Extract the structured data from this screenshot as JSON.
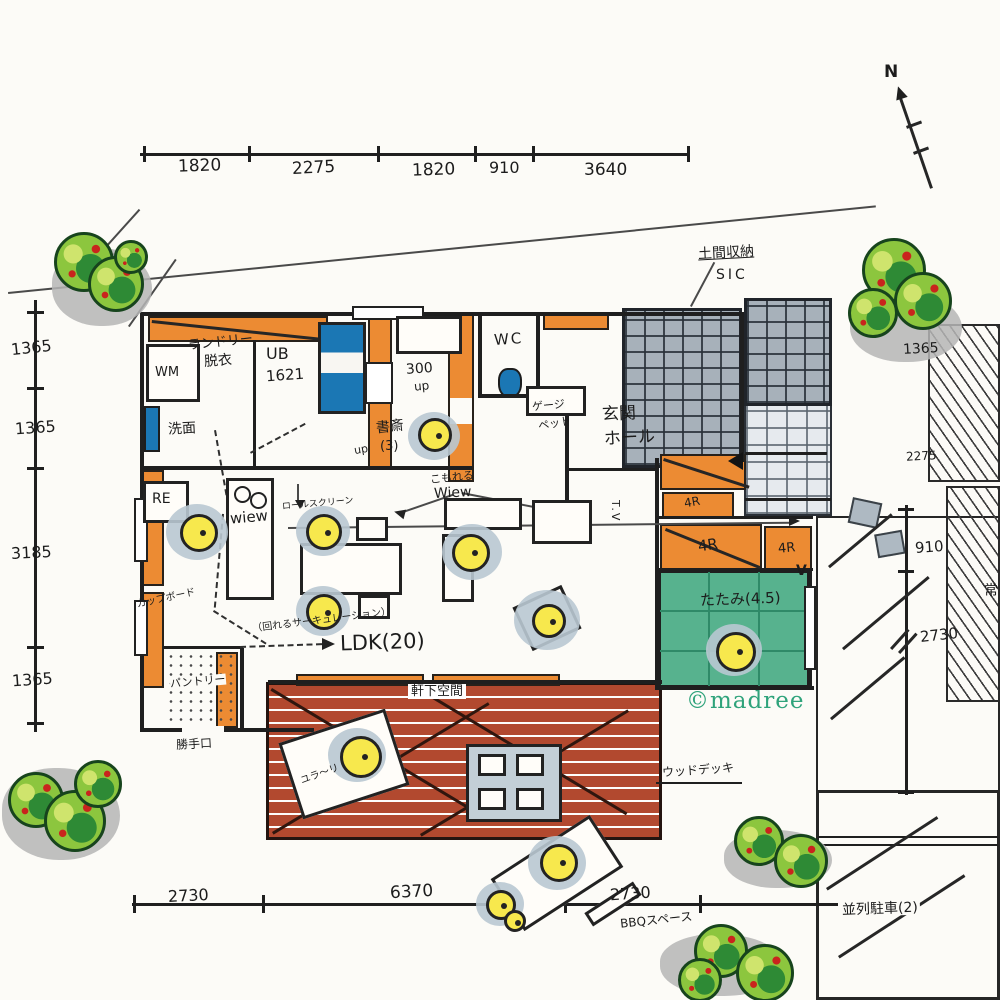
{
  "watermark": {
    "text": "©madree",
    "color": "#2fa37b"
  },
  "compass": {
    "label": "N"
  },
  "dims": {
    "top": [
      "1820",
      "2275",
      "1820",
      "910",
      "3640"
    ],
    "left": [
      "1365",
      "1365",
      "3185",
      "1365"
    ],
    "bottom": [
      "2730",
      "6370",
      "2730"
    ],
    "right_outer": [
      "1365",
      "2275"
    ],
    "right_inner": [
      "910",
      "2730"
    ]
  },
  "rooms": {
    "laundry1": "ランドリー",
    "laundry2": "脱衣",
    "wm": "WM",
    "ub": "UB",
    "ub_size": "1621",
    "washroom": "洗面",
    "fridge": "RE",
    "study": "書斎",
    "study_size": "(3)",
    "stair_rise": "300",
    "stair_up": "up",
    "hall_up": "up",
    "wc": "WC",
    "cage": "ゲージ",
    "pet": "ペット",
    "genkan": "玄関",
    "hall": "ホール",
    "doma": "土間収納",
    "sic": "SIC",
    "closet1": "4R",
    "closet2": "4R",
    "closet3": "4R",
    "tatami": "たたみ(4.5)",
    "v_mark": "V",
    "tv": "T.V",
    "ldk": "LDK(20)",
    "circulation": "（回れるサーキュレーション）",
    "cupboard": "カップボード",
    "view1": "wiew",
    "view2": "こもれる",
    "view3": "Wiew",
    "roll_screen": "ロールスクリーン",
    "pantry": "パントリー",
    "back_door": "勝手口"
  },
  "exterior": {
    "eaves": "軒下空間",
    "deck": "ウッドデッキ",
    "lounge": "ユラ〜リ",
    "bbq": "BBQスペース",
    "parking": "並列駐車(2)",
    "parking_side": "常"
  },
  "colors": {
    "ink": "#222222",
    "orange_wall": "#ec8b33",
    "tatami_green": "#57b28e",
    "deck_red": "#b2492f",
    "chair_yellow": "#f7e84d",
    "water_blue": "#1b77b4",
    "stone_gray": "#a7b1ba",
    "tree_green": "#8cc63e",
    "shadow_gray": "#b5b5b5",
    "watermark_green": "#2fa37b"
  }
}
